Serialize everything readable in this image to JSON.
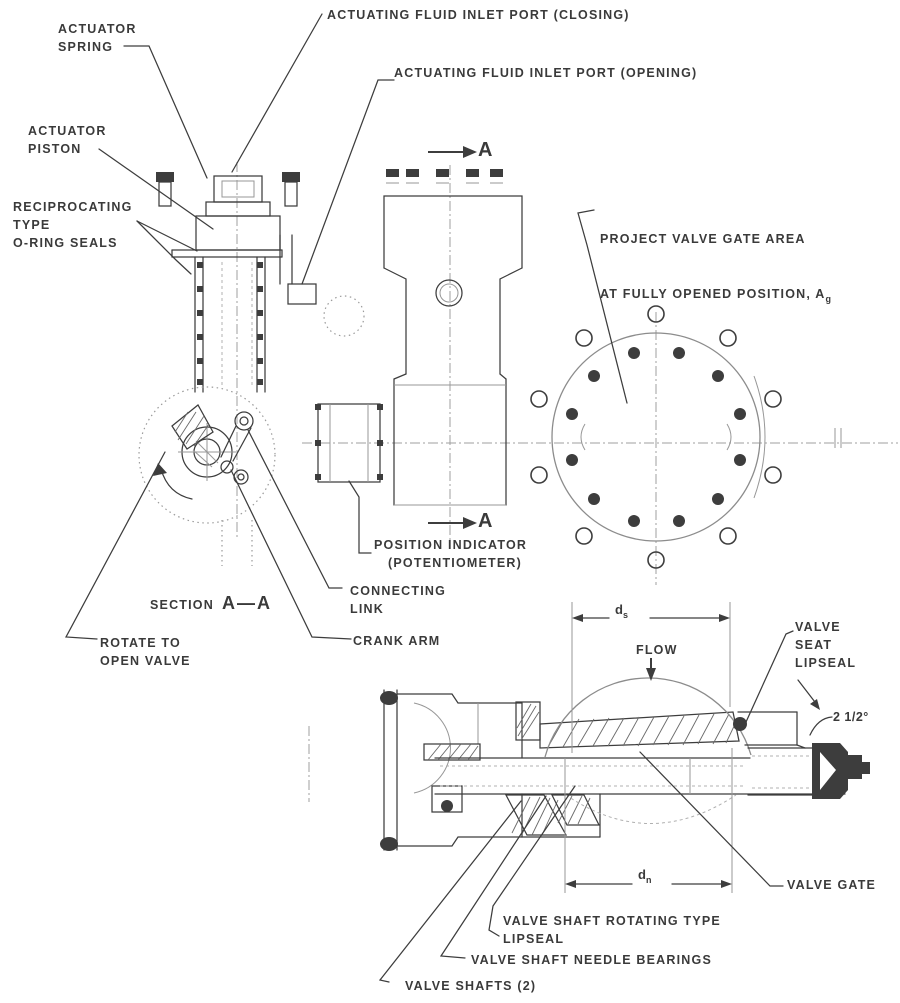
{
  "figure": {
    "type": "engineering-diagram",
    "callouts": {
      "actuator_spring": "ACTUATOR\nSPRING",
      "inlet_closing": "ACTUATING FLUID INLET PORT (CLOSING)",
      "inlet_opening": "ACTUATING FLUID INLET PORT (OPENING)",
      "actuator_piston": "ACTUATOR\nPISTON",
      "oring_seals": "RECIPROCATING\nTYPE\nO-RING SEALS",
      "project_gate_line1": "PROJECT VALVE GATE AREA",
      "project_gate_line2": "AT FULLY OPENED POSITION, A",
      "project_gate_sub": "g",
      "position_indicator": "POSITION INDICATOR\n   (POTENTIOMETER)",
      "connecting_link": "CONNECTING\nLINK",
      "crank_arm": "CRANK ARM",
      "rotate_open": "ROTATE TO\nOPEN VALVE",
      "flow": "FLOW",
      "valve_seat_lipseal": "VALVE\nSEAT\nLIPSEAL",
      "angle": "2 1/2°",
      "valve_gate": "VALVE GATE",
      "shaft_lipseal": "VALVE SHAFT ROTATING TYPE\nLIPSEAL",
      "needle_bearings": "VALVE SHAFT NEEDLE BEARINGS",
      "valve_shafts": "VALVE SHAFTS (2)"
    },
    "annotations": {
      "section_label": "SECTION",
      "section_value": "A—A",
      "cut_letter": "A",
      "dim_letter": "d",
      "dim_seat_sub": "s",
      "dim_nominal_sub": "n"
    },
    "colors": {
      "ink": "#3d3d3d",
      "paper": "#ffffff",
      "faint": "#979797"
    }
  }
}
